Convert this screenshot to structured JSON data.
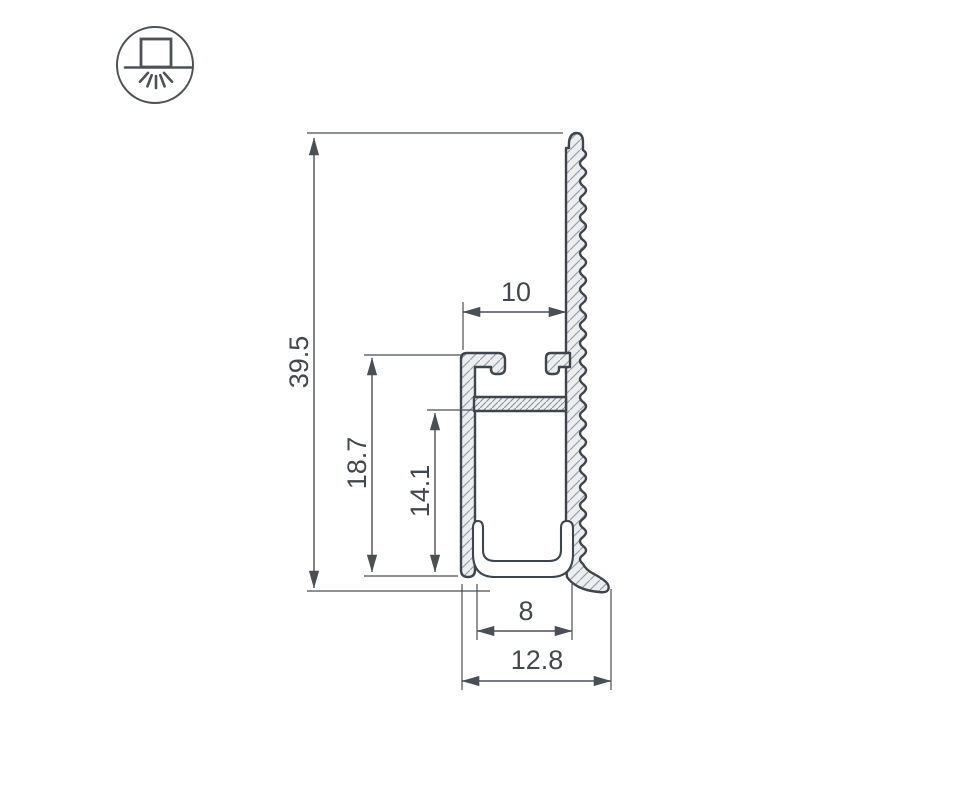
{
  "drawing": {
    "title": "led-profile-cross-section",
    "line_color": "#43484d",
    "fill_color": "#edeef0",
    "icon": {
      "name": "surface-mount-downlight-icon"
    },
    "dimensions": {
      "total_height": "39.5",
      "wall_height": "18.7",
      "cavity_height": "14.1",
      "top_slot_width": "10",
      "inner_width": "8",
      "base_width": "12.8"
    }
  }
}
